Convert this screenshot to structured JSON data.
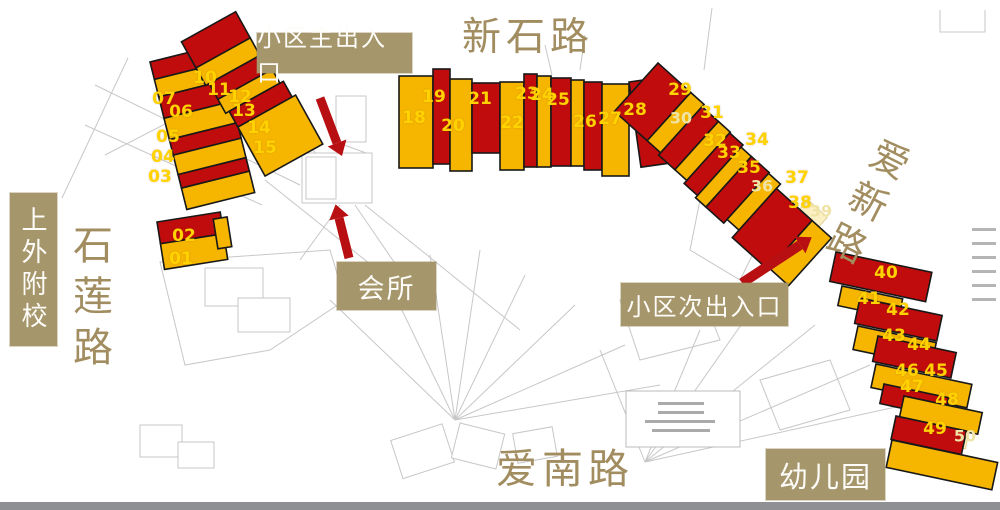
{
  "map": {
    "roads": [
      {
        "name": "xinshi-road",
        "label": "新石路"
      },
      {
        "name": "shilian-road",
        "label": "石莲路"
      },
      {
        "name": "aixin-road",
        "label": "爱新路"
      },
      {
        "name": "ainan-road",
        "label": "爱南路"
      }
    ],
    "annotations": [
      {
        "name": "main-entrance",
        "label": "小区主出入口"
      },
      {
        "name": "clubhouse",
        "label": "会所"
      },
      {
        "name": "secondary-entrance",
        "label": "小区次出入口"
      },
      {
        "name": "kindergarten",
        "label": "幼儿园"
      },
      {
        "name": "school",
        "label": "上外附校"
      }
    ],
    "buildings": [
      {
        "no": "01",
        "x": 181,
        "y": 259
      },
      {
        "no": "02",
        "x": 184,
        "y": 236
      },
      {
        "no": "03",
        "x": 160,
        "y": 177
      },
      {
        "no": "04",
        "x": 163,
        "y": 157
      },
      {
        "no": "05",
        "x": 168,
        "y": 137
      },
      {
        "no": "06",
        "x": 181,
        "y": 112
      },
      {
        "no": "07",
        "x": 164,
        "y": 99
      },
      {
        "no": "10",
        "x": 205,
        "y": 78
      },
      {
        "no": "11",
        "x": 219,
        "y": 90
      },
      {
        "no": "12",
        "x": 240,
        "y": 97
      },
      {
        "no": "13",
        "x": 244,
        "y": 111
      },
      {
        "no": "14",
        "x": 259,
        "y": 128
      },
      {
        "no": "15",
        "x": 265,
        "y": 148
      },
      {
        "no": "18",
        "x": 414,
        "y": 118
      },
      {
        "no": "19",
        "x": 434,
        "y": 97
      },
      {
        "no": "20",
        "x": 453,
        "y": 126
      },
      {
        "no": "21",
        "x": 480,
        "y": 99
      },
      {
        "no": "22",
        "x": 512,
        "y": 123
      },
      {
        "no": "23",
        "x": 527,
        "y": 94
      },
      {
        "no": "24",
        "x": 542,
        "y": 95
      },
      {
        "no": "25",
        "x": 558,
        "y": 100
      },
      {
        "no": "26",
        "x": 585,
        "y": 122
      },
      {
        "no": "27",
        "x": 610,
        "y": 119
      },
      {
        "no": "28",
        "x": 635,
        "y": 110
      },
      {
        "no": "29",
        "x": 680,
        "y": 90
      },
      {
        "no": "30",
        "x": 681,
        "y": 118,
        "pale": true
      },
      {
        "no": "31",
        "x": 712,
        "y": 113
      },
      {
        "no": "32",
        "x": 715,
        "y": 141
      },
      {
        "no": "33",
        "x": 729,
        "y": 153
      },
      {
        "no": "34",
        "x": 757,
        "y": 140
      },
      {
        "no": "35",
        "x": 749,
        "y": 168
      },
      {
        "no": "36",
        "x": 762,
        "y": 186,
        "pale": true
      },
      {
        "no": "37",
        "x": 797,
        "y": 178
      },
      {
        "no": "38",
        "x": 800,
        "y": 203
      },
      {
        "no": "39",
        "x": 821,
        "y": 211,
        "pale": true
      },
      {
        "no": "40",
        "x": 886,
        "y": 273
      },
      {
        "no": "41",
        "x": 869,
        "y": 299
      },
      {
        "no": "42",
        "x": 898,
        "y": 310
      },
      {
        "no": "43",
        "x": 894,
        "y": 336
      },
      {
        "no": "44",
        "x": 919,
        "y": 345
      },
      {
        "no": "46",
        "x": 907,
        "y": 371
      },
      {
        "no": "45",
        "x": 936,
        "y": 371
      },
      {
        "no": "47",
        "x": 912,
        "y": 387
      },
      {
        "no": "48",
        "x": 947,
        "y": 400
      },
      {
        "no": "49",
        "x": 935,
        "y": 429
      },
      {
        "no": "50",
        "x": 965,
        "y": 436,
        "pale": true
      }
    ],
    "colors": {
      "building_red": "#c00c0c",
      "building_yellow": "#f6b600",
      "number_yellow": "#ffd200",
      "number_pale": "#f0e3a6",
      "label_tan": "#a6966b",
      "road_text_tan": "#a28d60",
      "arrow_red": "#b70f12",
      "plan_line_gray": "#c7c7c7"
    }
  }
}
